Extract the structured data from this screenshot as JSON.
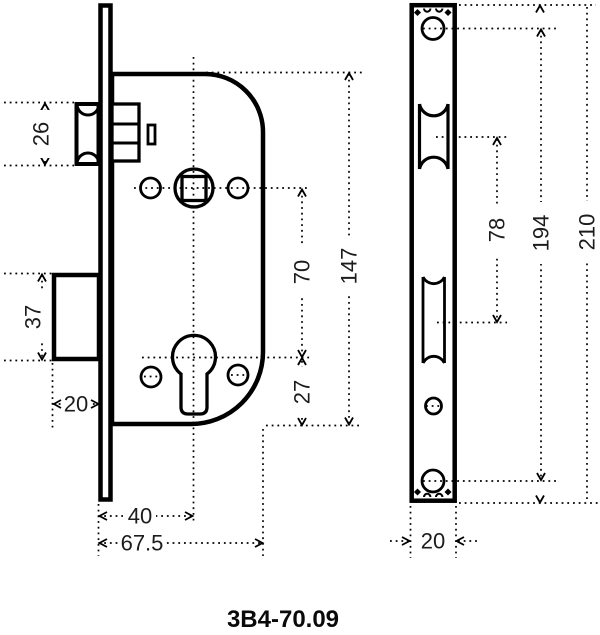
{
  "drawing": {
    "part_number": "3B4-70.09",
    "colors": {
      "line": "#000000",
      "background": "#ffffff"
    },
    "body_view": {
      "latch_height": "26",
      "deadbolt_height": "37",
      "deadbolt_throw": "20",
      "follower_to_cylinder": "70",
      "cylinder_to_edge": "27",
      "case_height": "147",
      "backset": "40",
      "case_depth": "67.5"
    },
    "plate_view": {
      "latch_to_bolt_centers": "78",
      "screw_hole_spacing": "194",
      "plate_height": "210",
      "plate_width": "20"
    }
  }
}
